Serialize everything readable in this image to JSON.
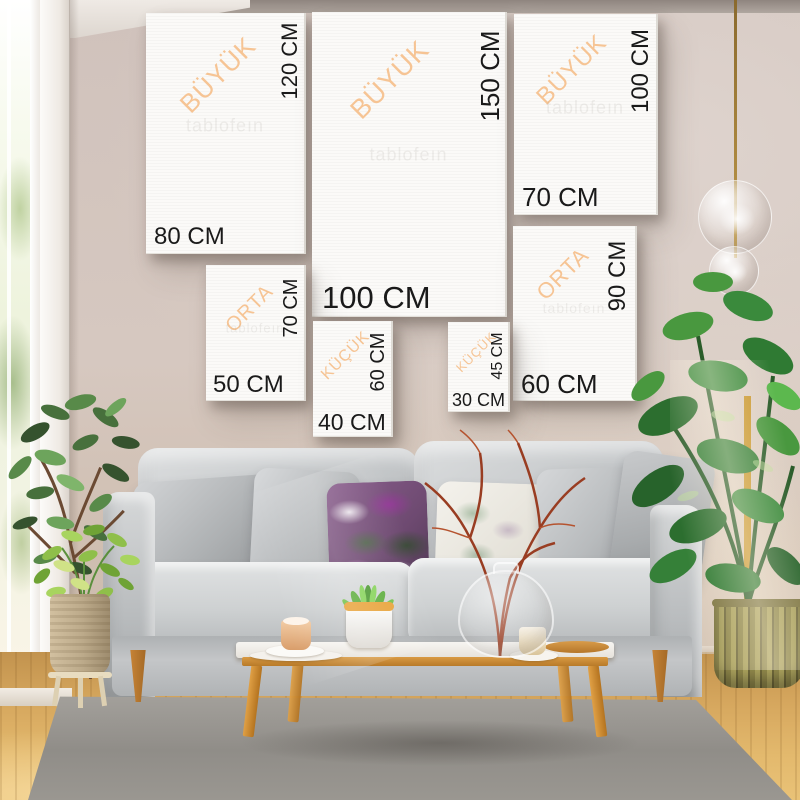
{
  "watermark": {
    "text": "tablofeın"
  },
  "palette": {
    "category_label": "#f6c494",
    "dimension_label": "#1a1a1a",
    "canvas_white": "#fbfaf8",
    "wall": "#d4c5bf",
    "sofa_gray": "#c6c8ca",
    "pillow_purple": "#7d5580",
    "floor_wood": "#d6a75e",
    "rug_gray": "#9a9791",
    "table_wood": "#cf8e3b",
    "plant_green": "#3a8a3c",
    "pendant_cord_gold": "#b08a3a"
  },
  "size_guide": {
    "canvases": [
      {
        "category": "BÜYÜK",
        "height_label": "120 CM",
        "width_label": "80 CM"
      },
      {
        "category": "BÜYÜK",
        "height_label": "150 CM",
        "width_label": "100 CM"
      },
      {
        "category": "BÜYÜK",
        "height_label": "100 CM",
        "width_label": "70 CM"
      },
      {
        "category": "ORTA",
        "height_label": "70 CM",
        "width_label": "50 CM"
      },
      {
        "category": "ORTA",
        "height_label": "90 CM",
        "width_label": "60 CM"
      },
      {
        "category": "KÜÇÜK",
        "height_label": "60 CM",
        "width_label": "40 CM"
      },
      {
        "category": "KÜÇÜK",
        "height_label": "45 CM",
        "width_label": "30 CM"
      }
    ]
  }
}
